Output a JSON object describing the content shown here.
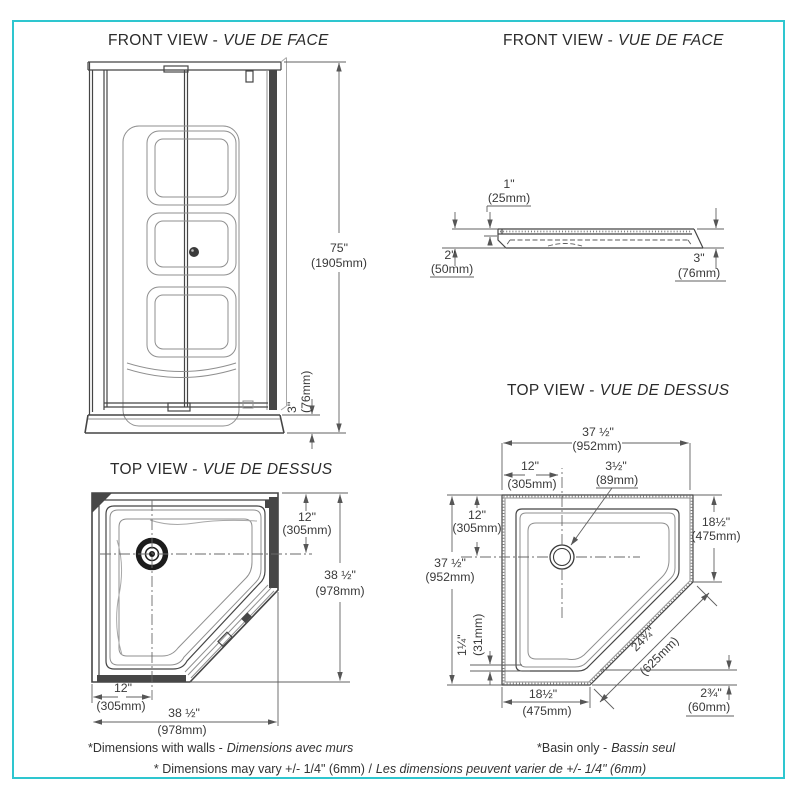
{
  "border_color": "#2ec6cf",
  "line_color": "#454545",
  "panels": {
    "front_unit": {
      "title_en": "FRONT VIEW -",
      "title_fr": "VUE DE FACE",
      "height_in": "75\"",
      "height_mm": "(1905mm)",
      "curb_in": "3\"",
      "curb_mm": "(76mm)"
    },
    "front_base": {
      "title_en": "FRONT VIEW -",
      "title_fr": "VUE DE FACE",
      "lip_in": "1\"",
      "lip_mm": "(25mm)",
      "height_left_in": "2\"",
      "height_left_mm": "(50mm)",
      "height_right_in": "3\"",
      "height_right_mm": "(76mm)"
    },
    "top_unit": {
      "title_en": "TOP VIEW -",
      "title_fr": "VUE DE DESSUS",
      "drain_top_in": "12\"",
      "drain_top_mm": "(305mm)",
      "side_in": "38 ½\"",
      "side_mm": "(978mm)",
      "drain_left_in": "12\"",
      "drain_left_mm": "(305mm)",
      "width_in": "38 ½\"",
      "width_mm": "(978mm)"
    },
    "top_base": {
      "title_en": "TOP VIEW -",
      "title_fr": "VUE DE DESSUS",
      "width_in": "37 ½\"",
      "width_mm": "(952mm)",
      "drain_x_in": "12\"",
      "drain_x_mm": "(305mm)",
      "drain_dia_in": "3½\"",
      "drain_dia_mm": "(89mm)",
      "drain_y_in": "12\"",
      "drain_y_mm": "(305mm)",
      "depth_in": "37 ½\"",
      "depth_mm": "(952mm)",
      "right_wall_in": "18½\"",
      "right_wall_mm": "(475mm)",
      "ledge_in": "1¼\"",
      "ledge_mm": "(31mm)",
      "diagonal_in": "24¾\"",
      "diagonal_mm": "(625mm)",
      "bottom_wall_in": "18½\"",
      "bottom_wall_mm": "(475mm)",
      "threshold_in": "2¾\"",
      "threshold_mm": "(60mm)"
    }
  },
  "footnotes": {
    "walls_en": "*Dimensions with walls -",
    "walls_fr": "Dimensions avec murs",
    "basin_en": "*Basin only -",
    "basin_fr": "Bassin seul",
    "tolerance_en": "* Dimensions may vary +/- 1/4\" (6mm) /",
    "tolerance_fr": "Les dimensions peuvent varier de +/- 1/4\" (6mm)"
  }
}
